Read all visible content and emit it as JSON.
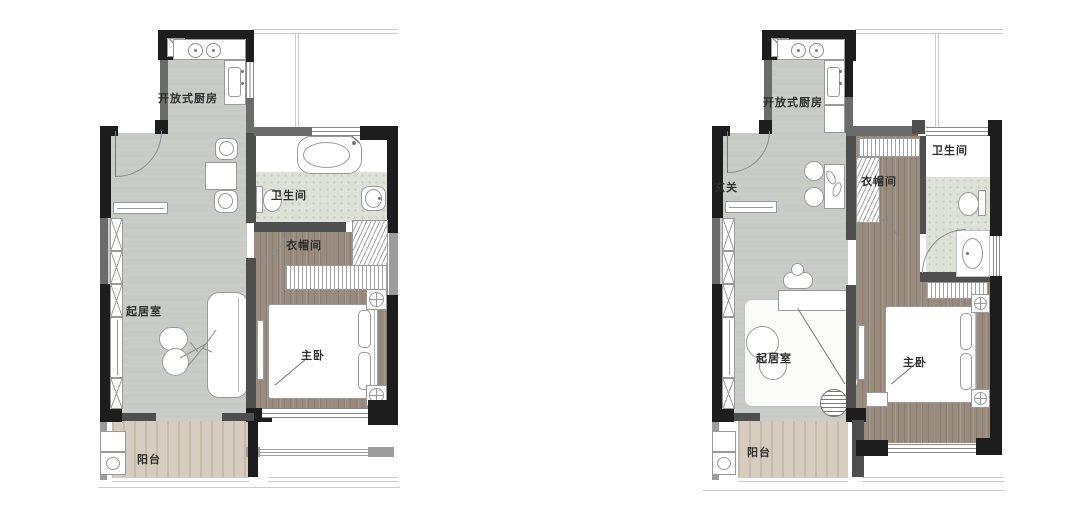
{
  "image": {
    "description": "Two residential one-bedroom floor plan drawings shown side by side on a white background",
    "background": "#ffffff"
  },
  "palette": {
    "wall_black": "#1d1d1d",
    "wall_dark_gray": "#4f4f4f",
    "wall_mid_gray": "#6b6b6b",
    "wall_light_gray": "#9c9c9c",
    "floor_living_gray": "#c8cac6",
    "floor_wood_brown": "#998c7f",
    "floor_balcony_tan": "#d6cdc0",
    "floor_bath_tile": "#dee1d7",
    "context_line_gray": "#cccccc",
    "furniture_outline": "#9a9a9a",
    "label_color": "#2e2e2e"
  },
  "plans": [
    {
      "name": "plan-left",
      "rooms": {
        "kitchen": "开放式厨房",
        "bathroom": "卫生间",
        "cloakroom": "衣帽间",
        "living": "起居室",
        "bedroom": "主卧",
        "balcony": "阳台"
      }
    },
    {
      "name": "plan-right",
      "rooms": {
        "kitchen": "开放式厨房",
        "entry": "玄关",
        "cloakroom": "衣帽间",
        "bathroom": "卫生间",
        "living": "起居室",
        "bedroom": "主卧",
        "balcony": "阳台"
      }
    }
  ]
}
